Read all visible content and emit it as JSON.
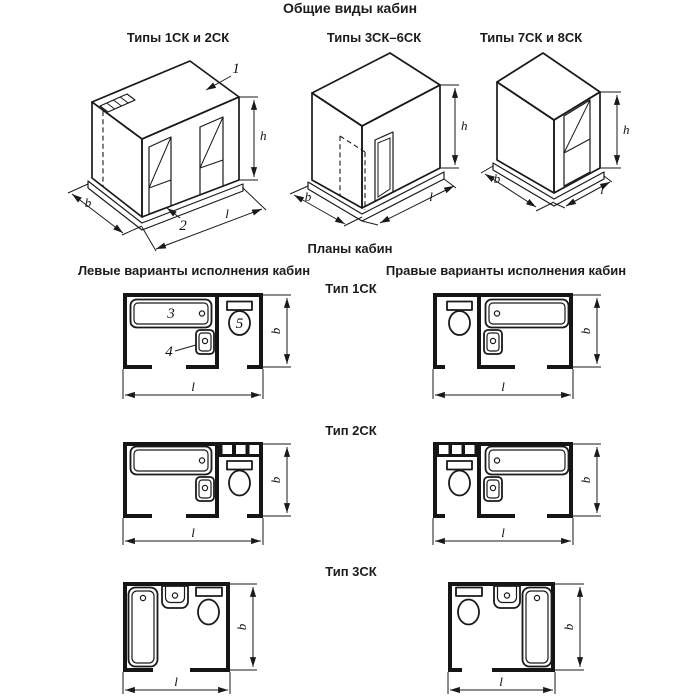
{
  "titles": {
    "main": "Общие виды кабин",
    "plans": "Планы кабин",
    "left_column": "Левые варианты исполнения кабин",
    "right_column": "Правые варианты исполнения кабин"
  },
  "iso_views": [
    {
      "label": "Типы 1СК и 2СК"
    },
    {
      "label": "Типы 3СК–6СК"
    },
    {
      "label": "Типы 7СК и 8СК"
    }
  ],
  "plan_rows": [
    {
      "label": "Тип 1СК"
    },
    {
      "label": "Тип 2СК"
    },
    {
      "label": "Тип 3СК"
    }
  ],
  "dims": {
    "b": "b",
    "l": "l",
    "h": "h"
  },
  "callouts": {
    "roof_panel": "1",
    "base_panel": "2",
    "bathtub": "3",
    "washbasin": "4",
    "toilet": "5"
  },
  "colors": {
    "line": "#1a1a1a",
    "background": "#ffffff"
  }
}
